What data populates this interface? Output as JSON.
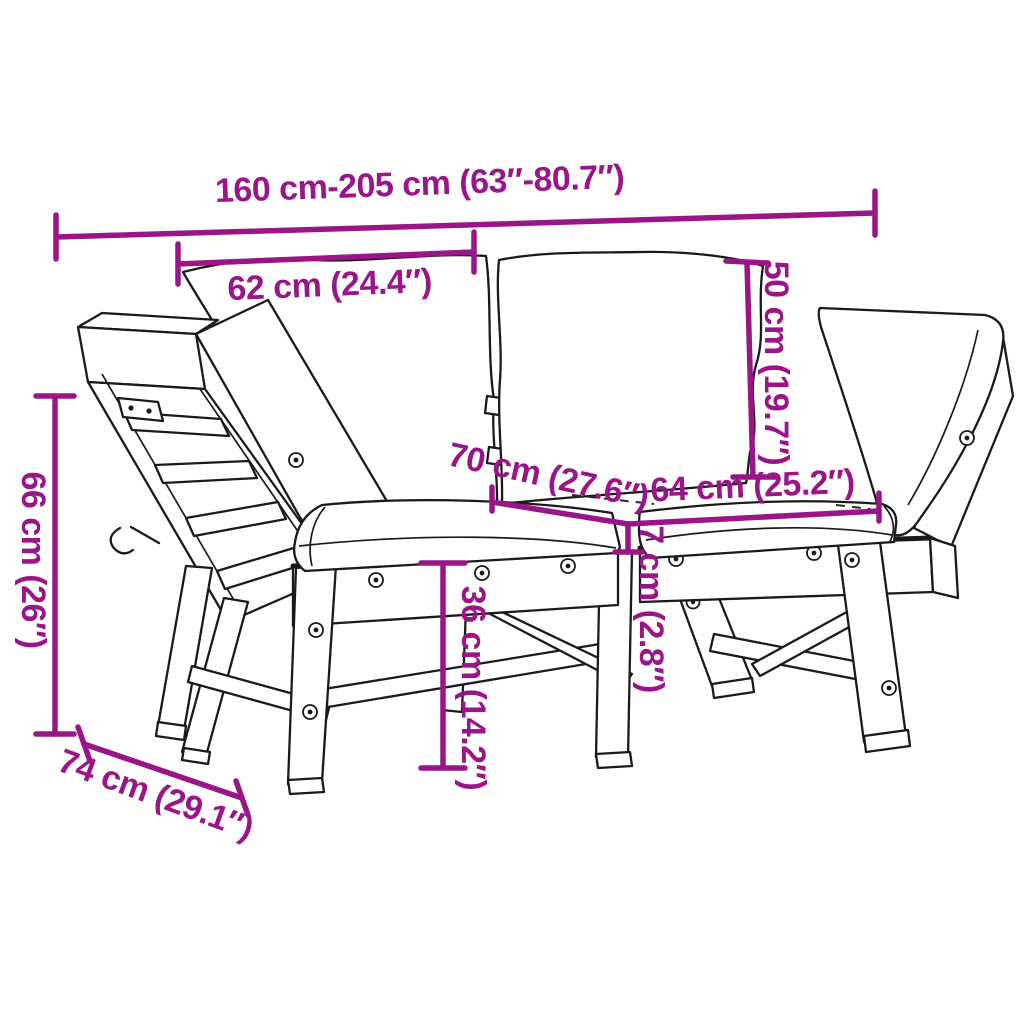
{
  "diagram": {
    "type": "product-dimension-diagram",
    "subject": "convertible garden bench with adjustable sides and cushions",
    "background_color": "#ffffff",
    "outline_color": "#1a1a1a",
    "accent_color": "#9A1588",
    "dimensions": {
      "overall_width": {
        "label": "160 cm-205 cm (63″-80.7″)",
        "orientation": "horizontal"
      },
      "back_cushion_width": {
        "label": "62 cm (24.4″)",
        "orientation": "horizontal"
      },
      "back_cushion_height": {
        "label": "50 cm (19.7″)",
        "orientation": "vertical"
      },
      "seat_depth": {
        "label": "70 cm (27.6″)",
        "orientation": "diagonal"
      },
      "seat_cushion_width": {
        "label": "64 cm (25.2″)",
        "orientation": "horizontal"
      },
      "cushion_thickness": {
        "label": "7 cm (2.8″)",
        "orientation": "vertical"
      },
      "seat_height": {
        "label": "36 cm (14.2″)",
        "orientation": "vertical"
      },
      "side_height": {
        "label": "66 cm (26″)",
        "orientation": "vertical"
      },
      "side_depth": {
        "label": "74 cm (29.1″)",
        "orientation": "diagonal"
      }
    }
  }
}
